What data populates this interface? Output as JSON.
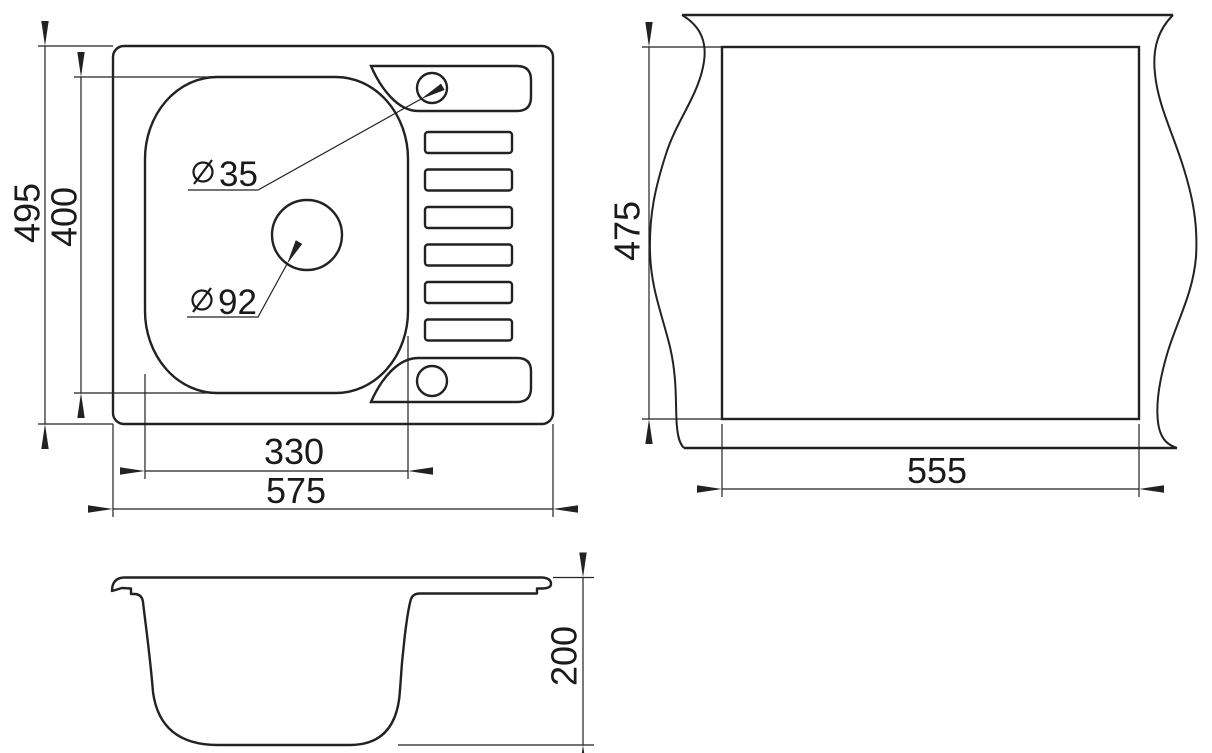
{
  "meta": {
    "description": "Technical dimension drawing of a kitchen sink with one bowl and a slotted drainboard: top view, countertop cutout view and side profile view",
    "line_color": "#222222",
    "background_color": "#ffffff"
  },
  "views": {
    "top": {
      "name": "sink top view",
      "overall_width": "575",
      "overall_depth": "495",
      "bowl_width": "330",
      "bowl_depth": "400",
      "faucet_hole": {
        "symbol": "⌀",
        "diameter": "35"
      },
      "drain_hole": {
        "symbol": "⌀",
        "diameter": "92"
      },
      "drainboard_slot_count": 6,
      "mount_hole_count": 2
    },
    "cutout": {
      "name": "countertop cutout view",
      "width": "555",
      "depth": "475"
    },
    "side": {
      "name": "sink side profile view",
      "bowl_height": "200"
    }
  }
}
